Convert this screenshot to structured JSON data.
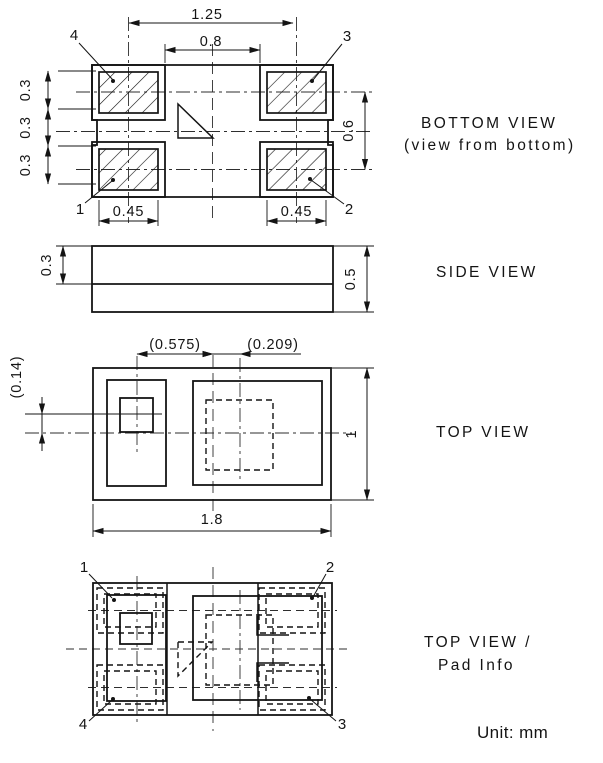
{
  "colors": {
    "line": "#141414",
    "background": "#ffffff"
  },
  "unit_label": "Unit: mm",
  "bottom_view": {
    "title": "BOTTOM VIEW",
    "subtitle": "(view from bottom)",
    "dim_pad_pitch_x": "1.25",
    "dim_pad_gap_x": "0.8",
    "vertical_dims": [
      "0.3",
      "0.3",
      "0.3"
    ],
    "dim_pad_width_left": "0.45",
    "dim_pad_width_right": "0.45",
    "dim_pad_pitch_y": "0.6",
    "pins": {
      "top_left": "4",
      "top_right": "3",
      "bottom_left": "1",
      "bottom_right": "2"
    }
  },
  "side_view": {
    "title": "SIDE VIEW",
    "dim_lid_height": "0.3",
    "dim_total_height": "0.5"
  },
  "top_view": {
    "title": "TOP VIEW",
    "dim_crystal_offset_x": "(0.575)",
    "dim_mark_offset_x": "(0.209)",
    "dim_mark_offset_y": "(0.14)",
    "dim_body_width": "1.8",
    "dim_body_height": "1"
  },
  "pad_info_view": {
    "title_line1": "TOP VIEW /",
    "title_line2": "Pad Info",
    "pins": {
      "top_left": "1",
      "top_right": "2",
      "bottom_right": "3",
      "bottom_left": "4"
    }
  }
}
